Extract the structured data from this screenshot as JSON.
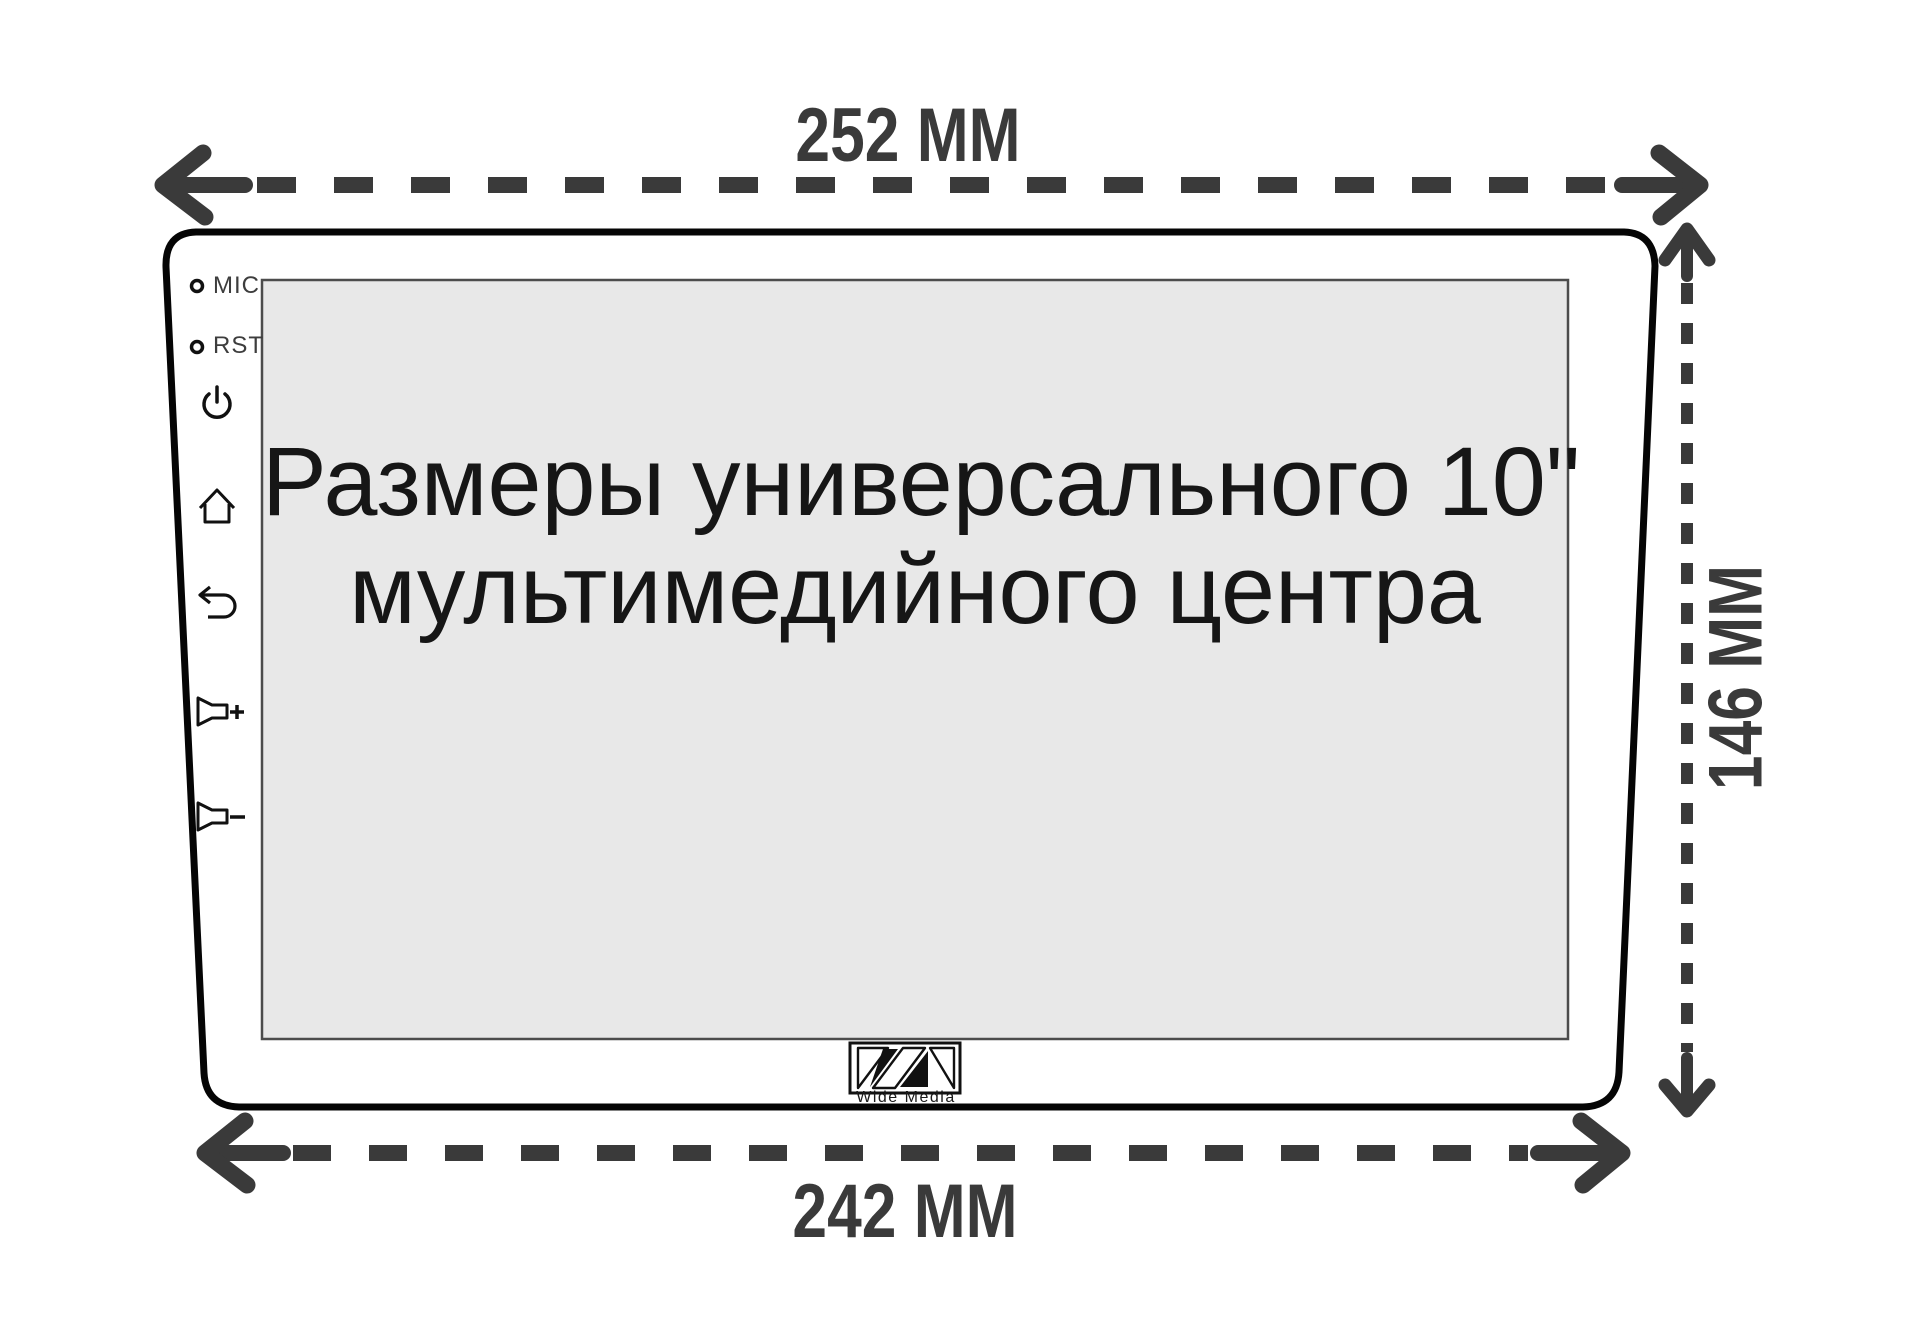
{
  "diagram": {
    "title_line1": "Размеры универсального 10\"",
    "title_line2": "мультимедийного центра",
    "dimensions": {
      "top_width": "252 MM",
      "bottom_width": "242 MM",
      "right_height": "146 MM"
    },
    "bezel": {
      "mic_label": "MIC",
      "rst_label": "RST",
      "icon_names": [
        "power-icon",
        "home-icon",
        "back-icon",
        "volume-up-icon",
        "volume-down-icon"
      ]
    },
    "brand": {
      "logo_text": "Wide Media",
      "logo_icon": "wm-logo-icon"
    },
    "colors": {
      "background": "#ffffff",
      "outline": "#050505",
      "screen_fill": "#e8e8e8",
      "screen_border": "#4c4c4c",
      "arrow": "#3a3a3a",
      "title_text": "#161616"
    }
  }
}
